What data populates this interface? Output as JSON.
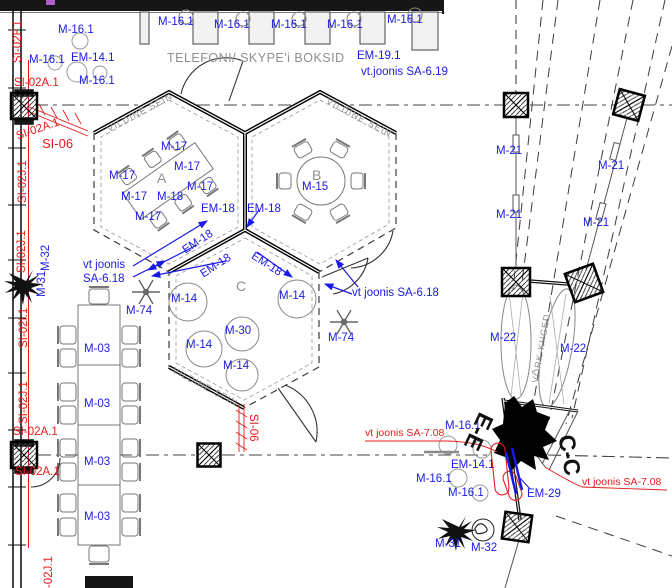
{
  "colors": {
    "b": "#1a1ae6",
    "r": "#e51c1c",
    "g": "#8f8f8f",
    "k": "#111111"
  },
  "structure": {
    "booth_area_title": "TELEFONI/ SKYPE'i BOKSID",
    "rooms": [
      {
        "id": "A",
        "wall_note": "VILDINE SEIN",
        "items": [
          "M-17",
          "M-18"
        ]
      },
      {
        "id": "B",
        "wall_note": "VILDINE SEIN",
        "items": [
          "M-15"
        ]
      },
      {
        "id": "C",
        "wall_note": "VILDINE SEIN",
        "items": [
          "M-14",
          "M-30"
        ]
      }
    ],
    "swings_note": "VÕRK-KIIGED",
    "section_marks": [
      "E-E",
      "C-C"
    ],
    "reference_notes": [
      "vt.joonis SA-6.19",
      "vt joonis SA-6.18",
      "vt joonis SA-7.08"
    ]
  },
  "labels": [
    {
      "t": "M-16.1",
      "x": 58,
      "y": 25
    },
    {
      "t": "M-16.1",
      "x": 158,
      "y": 17
    },
    {
      "t": "M-16.1",
      "x": 214,
      "y": 20
    },
    {
      "t": "M-16.1",
      "x": 271,
      "y": 20
    },
    {
      "t": "M-16.1",
      "x": 327,
      "y": 20
    },
    {
      "t": "M-16.1",
      "x": 387,
      "y": 15
    },
    {
      "t": "M-16.1",
      "x": 29,
      "y": 55
    },
    {
      "t": "EM-14.1",
      "x": 71,
      "y": 53
    },
    {
      "t": "M-16.1",
      "x": 79,
      "y": 76
    },
    {
      "t": "EM-19.1",
      "x": 357,
      "y": 51
    },
    {
      "t": "vt.joonis SA-6.19",
      "x": 361,
      "y": 67
    },
    {
      "t": "M-17",
      "x": 161,
      "y": 142
    },
    {
      "t": "M-17",
      "x": 174,
      "y": 162
    },
    {
      "t": "M-17",
      "x": 187,
      "y": 182
    },
    {
      "t": "M-17",
      "x": 109,
      "y": 171
    },
    {
      "t": "M-17",
      "x": 121,
      "y": 192
    },
    {
      "t": "M-17",
      "x": 135,
      "y": 212
    },
    {
      "t": "M-18",
      "x": 157,
      "y": 192
    },
    {
      "t": "A",
      "x": 157,
      "y": 171,
      "c": "g",
      "s": 14
    },
    {
      "t": "B",
      "x": 312,
      "y": 168,
      "c": "g",
      "s": 14
    },
    {
      "t": "M-15",
      "x": 302,
      "y": 182
    },
    {
      "t": "C",
      "x": 236,
      "y": 279,
      "c": "g",
      "s": 14
    },
    {
      "t": "EM-18",
      "x": 201,
      "y": 204
    },
    {
      "t": "EM-18",
      "x": 247,
      "y": 204
    },
    {
      "t": "EM-18",
      "x": 181,
      "y": 247,
      "r": -33
    },
    {
      "t": "EM-18",
      "x": 199,
      "y": 271,
      "r": -33
    },
    {
      "t": "EM-18",
      "x": 255,
      "y": 251,
      "r": 33
    },
    {
      "t": "vt joonis",
      "x": 83,
      "y": 260
    },
    {
      "t": "SA-6.18",
      "x": 83,
      "y": 274
    },
    {
      "t": "vt joonis SA-6.18",
      "x": 352,
      "y": 288
    },
    {
      "t": "M-74",
      "x": 126,
      "y": 306
    },
    {
      "t": "M-74",
      "x": 328,
      "y": 333
    },
    {
      "t": "M-14",
      "x": 171,
      "y": 294
    },
    {
      "t": "M-14",
      "x": 279,
      "y": 291
    },
    {
      "t": "M-14",
      "x": 186,
      "y": 340
    },
    {
      "t": "M-14",
      "x": 223,
      "y": 361
    },
    {
      "t": "M-30",
      "x": 225,
      "y": 326
    },
    {
      "t": "M-03",
      "x": 84,
      "y": 344
    },
    {
      "t": "M-03",
      "x": 84,
      "y": 399
    },
    {
      "t": "M-03",
      "x": 84,
      "y": 457
    },
    {
      "t": "M-03",
      "x": 84,
      "y": 512
    },
    {
      "t": "M-32",
      "x": 41,
      "y": 271,
      "r": -90
    },
    {
      "t": "M-31",
      "x": 37,
      "y": 297,
      "r": -90
    },
    {
      "t": "M-21",
      "x": 496,
      "y": 146
    },
    {
      "t": "M-21",
      "x": 598,
      "y": 161
    },
    {
      "t": "M-21",
      "x": 496,
      "y": 210
    },
    {
      "t": "M-21",
      "x": 583,
      "y": 218
    },
    {
      "t": "M-22",
      "x": 490,
      "y": 333
    },
    {
      "t": "M-22",
      "x": 560,
      "y": 344
    },
    {
      "t": "M-16.1",
      "x": 445,
      "y": 421
    },
    {
      "t": "EM-14.1",
      "x": 451,
      "y": 460
    },
    {
      "t": "M-16.1",
      "x": 416,
      "y": 474
    },
    {
      "t": "M-16.1",
      "x": 448,
      "y": 488
    },
    {
      "t": "EM-29",
      "x": 527,
      "y": 489
    },
    {
      "t": "M-31",
      "x": 435,
      "y": 539
    },
    {
      "t": "M-32",
      "x": 471,
      "y": 543
    },
    {
      "t": "SI-02F.1",
      "x": 13,
      "y": 63,
      "c": "r",
      "r": -90
    },
    {
      "t": "SI-02A.1",
      "x": 14,
      "y": 78,
      "c": "r"
    },
    {
      "t": "SI-02A.1",
      "x": 15,
      "y": 132,
      "c": "r",
      "r": -19
    },
    {
      "t": "SI-06",
      "x": 42,
      "y": 137,
      "c": "r",
      "s": 13
    },
    {
      "t": "SI-02J.1",
      "x": 18,
      "y": 203,
      "c": "r",
      "r": -90
    },
    {
      "t": "SI-02J.1",
      "x": 17,
      "y": 273,
      "c": "r",
      "r": -90
    },
    {
      "t": "SI-02I.1",
      "x": 19,
      "y": 348,
      "c": "r",
      "r": -90
    },
    {
      "t": "SI-02J.1",
      "x": 19,
      "y": 424,
      "c": "r",
      "r": -90
    },
    {
      "t": "SI-02A.1",
      "x": 13,
      "y": 427,
      "c": "r"
    },
    {
      "t": "SI-02A.1",
      "x": 15,
      "y": 467,
      "c": "r"
    },
    {
      "t": "SI-02J.1",
      "x": 44,
      "y": 599,
      "c": "r",
      "r": -90
    },
    {
      "t": "SI-06",
      "x": 258,
      "y": 414,
      "c": "r",
      "r": 90
    },
    {
      "t": "vt joonis SA-7.08",
      "x": 365,
      "y": 428,
      "c": "r",
      "s": 10.5
    },
    {
      "t": "vt joonis SA-7.08",
      "x": 582,
      "y": 477,
      "c": "r",
      "s": 10.5
    },
    {
      "t": "TELEFONI/ SKYPE'i BOKSID",
      "x": 167,
      "y": 52,
      "c": "g",
      "s": 12.5,
      "ls": 0.5
    },
    {
      "t": "VILDINE SEIN",
      "x": 106,
      "y": 126,
      "c": "g",
      "r": -28,
      "s": 9,
      "ls": 1.2
    },
    {
      "t": "VILDINE SEIN",
      "x": 329,
      "y": 97,
      "c": "g",
      "r": 28,
      "s": 9,
      "ls": 1.2
    },
    {
      "t": "VILDINE SEIN",
      "x": 175,
      "y": 366,
      "c": "g",
      "r": 28,
      "s": 9,
      "ls": 1.2
    },
    {
      "t": "VÕRK-KIIGED",
      "x": 531,
      "y": 382,
      "c": "g",
      "r": -80,
      "s": 9,
      "ls": 1
    },
    {
      "t": "E-E",
      "x": 497,
      "y": 419,
      "c": "k",
      "r": 115,
      "s": 23,
      "b": 1
    },
    {
      "t": "C-C",
      "x": 577,
      "y": 433,
      "c": "k",
      "r": 80,
      "s": 23,
      "b": 1
    }
  ]
}
